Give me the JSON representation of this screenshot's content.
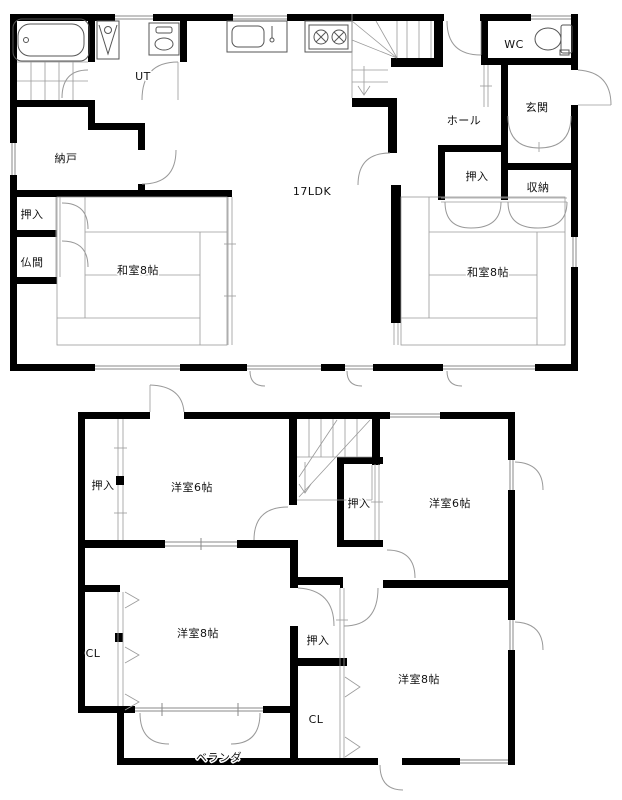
{
  "floor1": {
    "labels": {
      "ut": "UT",
      "nando": "納戸",
      "ldk": "17LDK",
      "hall": "ホール",
      "wc": "WC",
      "genkan": "玄関",
      "oshiire_right": "押入",
      "shuno": "収納",
      "oshiire_left": "押入",
      "butsuma": "仏間",
      "washitsu_left": "和室8帖",
      "washitsu_right": "和室8帖"
    }
  },
  "floor2": {
    "labels": {
      "oshiire_nw": "押入",
      "yoshitsu_nw": "洋室6帖",
      "oshiire_mid_upper": "押入",
      "yoshitsu_ne": "洋室6帖",
      "cl_west": "CL",
      "yoshitsu_sw": "洋室8帖",
      "oshiire_mid_lower": "押入",
      "cl_mid": "CL",
      "yoshitsu_se": "洋室8帖",
      "veranda": "ベランダ"
    }
  },
  "colors": {
    "wall": "#000000",
    "line": "#777777",
    "background": "#ffffff",
    "text": "#111111"
  }
}
